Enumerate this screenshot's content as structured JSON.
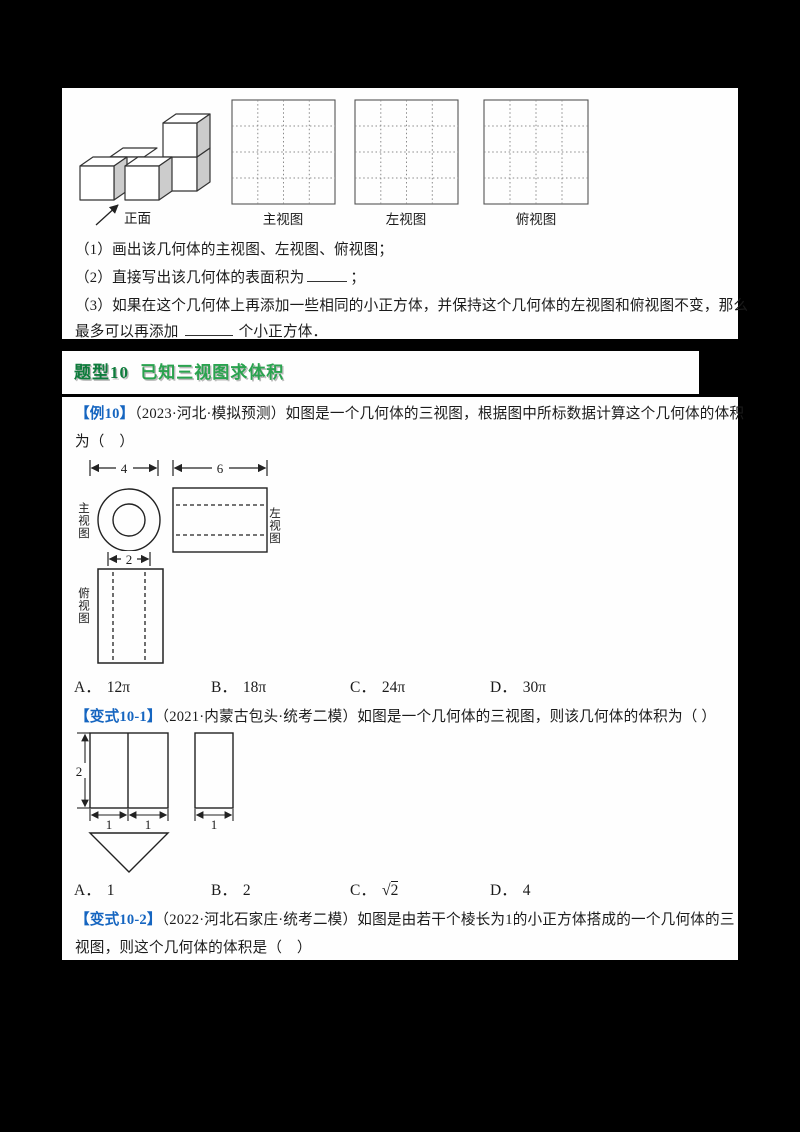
{
  "overview_figure": {
    "front_label": "正面",
    "grid_labels": [
      "主视图",
      "左视图",
      "俯视图"
    ]
  },
  "problem": {
    "part1": "（1）画出该几何体的主视图、左视图、俯视图；",
    "part2_before": "（2）直接写出该几何体的表面积为",
    "part2_after": "；",
    "part3": "（3）如果在这个几何体上再添加一些相同的小正方体，并保持这个几何体的左视图和俯视图不变，那么",
    "part4_before": "最多可以再添加",
    "part4_after": "个小正方体．"
  },
  "section_banner": {
    "tag": "题型10",
    "title": "已知三视图求体积"
  },
  "example10": {
    "label": "【例10】",
    "line1_rest": "（2023·河北·模拟预测）如图是一个几何体的三视图，根据图中所标数据计算这个几何体的体积",
    "line2": "为（　）",
    "diagram": {
      "front_label": "主视图",
      "side_label": "左视图",
      "top_label": "俯视图",
      "dim_front_width": "4",
      "dim_side_width": "6",
      "dim_inner": "2"
    },
    "options": [
      {
        "key": "A．",
        "value": "12π"
      },
      {
        "key": "B．",
        "value": "18π"
      },
      {
        "key": "C．",
        "value": "24π"
      },
      {
        "key": "D．",
        "value": "30π"
      }
    ]
  },
  "variation1": {
    "label": "【变式10-1】",
    "line_rest": "（2021·内蒙古包头·统考二模）如图是一个几何体的三视图，则该几何体的体积为（ ）",
    "diagram": {
      "dim_height": "2",
      "dim_front_left": "1",
      "dim_front_right": "1",
      "dim_side": "1"
    },
    "options": [
      {
        "key": "A．",
        "value": "1"
      },
      {
        "key": "B．",
        "value": "2"
      },
      {
        "key": "C．",
        "sqrt_sign": "√",
        "value": "2"
      },
      {
        "key": "D．",
        "value": "4"
      }
    ]
  },
  "variation2": {
    "label": "【变式10-2】",
    "line1_rest": "（2022·河北石家庄·统考二模）如图是由若干个棱长为1的小正方体搭成的一个几何体的三",
    "line2": "视图，则这个几何体的体积是（　）"
  }
}
